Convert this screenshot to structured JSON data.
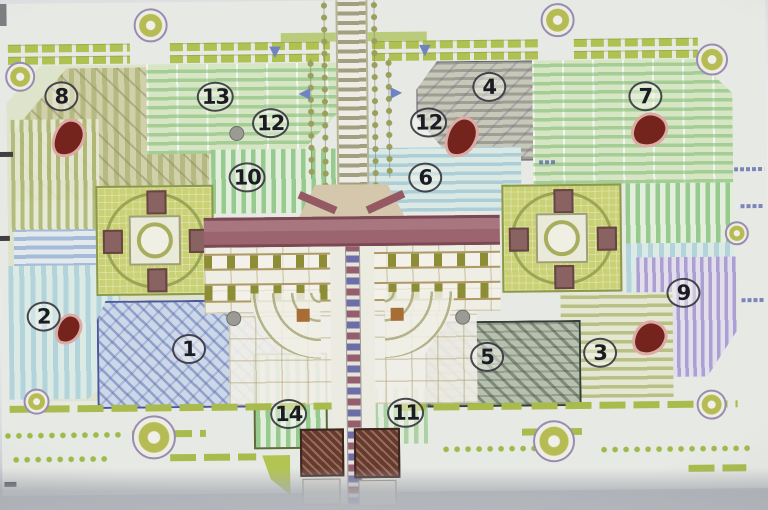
{
  "plan": {
    "zone_labels": [
      {
        "label": "1",
        "x": 188,
        "y": 347
      },
      {
        "label": "2",
        "x": 43,
        "y": 313
      },
      {
        "label": "3",
        "x": 599,
        "y": 355
      },
      {
        "label": "4",
        "x": 491,
        "y": 88
      },
      {
        "label": "5",
        "x": 486,
        "y": 358
      },
      {
        "label": "6",
        "x": 426,
        "y": 178
      },
      {
        "label": "7",
        "x": 647,
        "y": 99
      },
      {
        "label": "8",
        "x": 63,
        "y": 93
      },
      {
        "label": "9",
        "x": 683,
        "y": 296
      },
      {
        "label": "10",
        "x": 248,
        "y": 176
      },
      {
        "label": "11",
        "x": 404,
        "y": 413
      },
      {
        "label": "12",
        "x": 272,
        "y": 122
      },
      {
        "label": "12",
        "x": 430,
        "y": 123
      },
      {
        "label": "13",
        "x": 217,
        "y": 95
      },
      {
        "label": "14",
        "x": 287,
        "y": 413
      }
    ],
    "markers": {
      "tree_blobs": [
        {
          "x": 70,
          "y": 135,
          "w": 26,
          "h": 34
        },
        {
          "x": 463,
          "y": 138,
          "w": 26,
          "h": 36
        },
        {
          "x": 651,
          "y": 133,
          "w": 30,
          "h": 30
        },
        {
          "x": 68,
          "y": 326,
          "w": 20,
          "h": 26
        },
        {
          "x": 649,
          "y": 341,
          "w": 28,
          "h": 30
        }
      ],
      "rosettes": [
        {
          "x": 22,
          "y": 73,
          "s": 26
        },
        {
          "x": 153,
          "y": 23,
          "s": 30
        },
        {
          "x": 560,
          "y": 22,
          "s": 30
        },
        {
          "x": 714,
          "y": 63,
          "s": 28
        },
        {
          "x": 35,
          "y": 398,
          "s": 22
        },
        {
          "x": 152,
          "y": 435,
          "s": 40
        },
        {
          "x": 552,
          "y": 443,
          "s": 38
        },
        {
          "x": 710,
          "y": 408,
          "s": 26
        },
        {
          "x": 737,
          "y": 237,
          "s": 20
        }
      ],
      "gray_dots": [
        {
          "x": 238,
          "y": 132
        },
        {
          "x": 233,
          "y": 317
        },
        {
          "x": 462,
          "y": 318
        }
      ],
      "chevrons": [
        {
          "glyph": "◀",
          "x": 306,
          "y": 92
        },
        {
          "glyph": "▶",
          "x": 398,
          "y": 92
        },
        {
          "glyph": "▼",
          "x": 427,
          "y": 50
        },
        {
          "glyph": "▼",
          "x": 277,
          "y": 50
        }
      ]
    },
    "palette": {
      "chartreuse": "#afc43e",
      "light_green": "#d7e9c0",
      "green_stripe": "#73be69",
      "light_blue": "#aed3df",
      "blue_outline": "#4553a8",
      "lavender": "#b9a8d8",
      "maroon_band": "#a2606c",
      "dark_red_blob": "#7c1c14",
      "tan": "#c9cab8",
      "olive_window": "#8d8d26",
      "paper": "#eaece8",
      "photo_gray": "#b4b8bd"
    }
  }
}
